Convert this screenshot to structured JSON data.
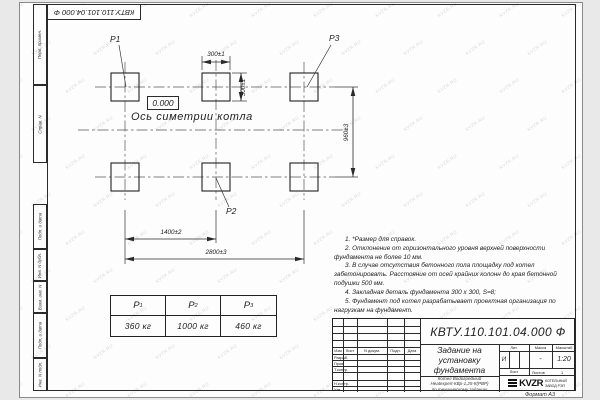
{
  "doc_number": "КВТУ.110.101.04.000  Ф",
  "watermark": {
    "text": "KVZR.RU"
  },
  "sidebar": {
    "cells": [
      "Перв. примен.",
      "Справ. N",
      "Подп. и дата",
      "Инв. N дубл.",
      "Взам. инв. N",
      "Подп. и дата",
      "Инв. N подл."
    ]
  },
  "drawing": {
    "labels": {
      "p1": "P1",
      "p2": "P2",
      "p3": "P3"
    },
    "elevation": "0.000",
    "axis_label": "Ось симетрии котла",
    "dimensions": {
      "pad_width": "300±1",
      "pad_height": "300±1",
      "row_spacing": "960±3",
      "col_spacing": "1400±2",
      "total_width": "2800±3"
    }
  },
  "load_table": {
    "headers": [
      {
        "base": "P",
        "sub": "1"
      },
      {
        "base": "P",
        "sub": "2"
      },
      {
        "base": "P",
        "sub": "3"
      }
    ],
    "values": [
      "360 кг",
      "1000 кг",
      "460 кг"
    ]
  },
  "notes": [
    "1. *Размер для справок.",
    "2. Отклонение от горизонтального уровня верхней поверхности фундамента не более 10 мм.",
    "3. В случае отсутствия бетонного пола площадку под котел забетонировать. Расстояние от осей крайних колонн до края бетонной подушки 500 мм.",
    "4. Закладная деталь фундамента 300 х 300, S=8;",
    "5. Фундамент под котел разрабатывает проектная организация по нагрузкам на фундамент."
  ],
  "title_block": {
    "header_cols": [
      "Изм",
      "Лист",
      "N докум.",
      "Подп.",
      "Дата"
    ],
    "sig_rows": [
      "Разраб.",
      "Пров.",
      "Т.контр.",
      "Н.контр.",
      "Утв."
    ],
    "title_lines": [
      "Задание на",
      "установку",
      "фундамента"
    ],
    "subtitle_lines": [
      "Котел Водогрейный",
      "Heatexpert-КВр-1,25-К(РВР)",
      "по техническому заданию"
    ],
    "lit_label": "Лит.",
    "mass_label": "Масса",
    "scale_label": "Масштаб",
    "lit_value": "И",
    "mass_value": "-",
    "scale_value": "1:20",
    "sheet_label": "Лист",
    "sheets_label": "Листов",
    "sheets_value": "1",
    "logo_text": "KVZR",
    "logo_caption_lines": [
      "КОТЕЛЬНЫЙ",
      "ЗАВОД РЭП"
    ],
    "format_label": "Формат А3"
  }
}
